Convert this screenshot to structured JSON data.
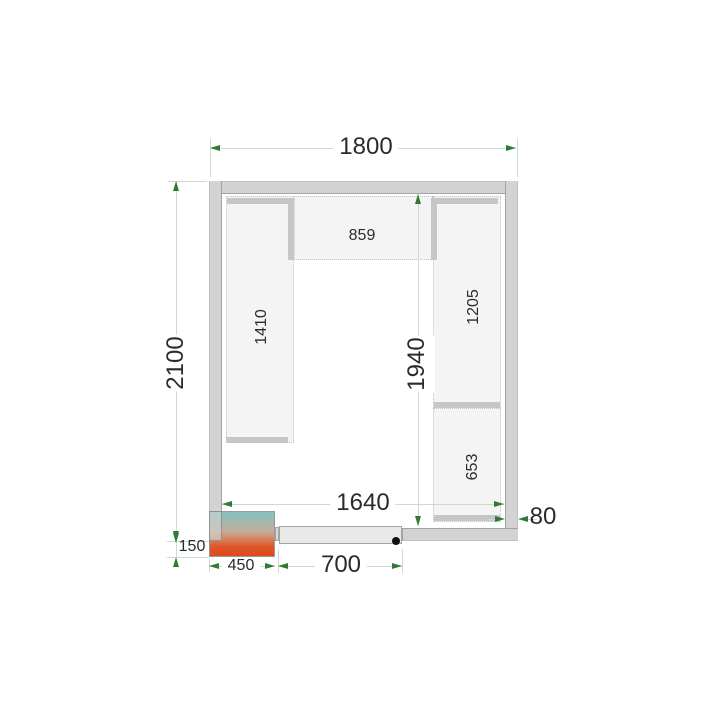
{
  "labels": {
    "overall_width": "1800",
    "overall_depth": "2100",
    "inner_depth": "1940",
    "inner_width": "1640",
    "wall_thickness": "80",
    "shelf_top": "859",
    "shelf_left": "1410",
    "shelf_right_upper": "1205",
    "shelf_right_lower": "653",
    "unit_protrusion": "150",
    "unit_width": "450",
    "door_width": "700"
  },
  "colors": {
    "wall": "#d3d3d3",
    "shelf_fill": "#f4f4f4",
    "shelf_band": "#c6c6c6",
    "dimension_line": "#cbdccd",
    "dimension_arrow": "#2e7b33",
    "text": "#2b2b2b",
    "door_panel": "#e9e9e9",
    "cooling_unit_gradient_top": "#82c2c1",
    "cooling_unit_gradient_bottom": "#dd4a1b"
  }
}
